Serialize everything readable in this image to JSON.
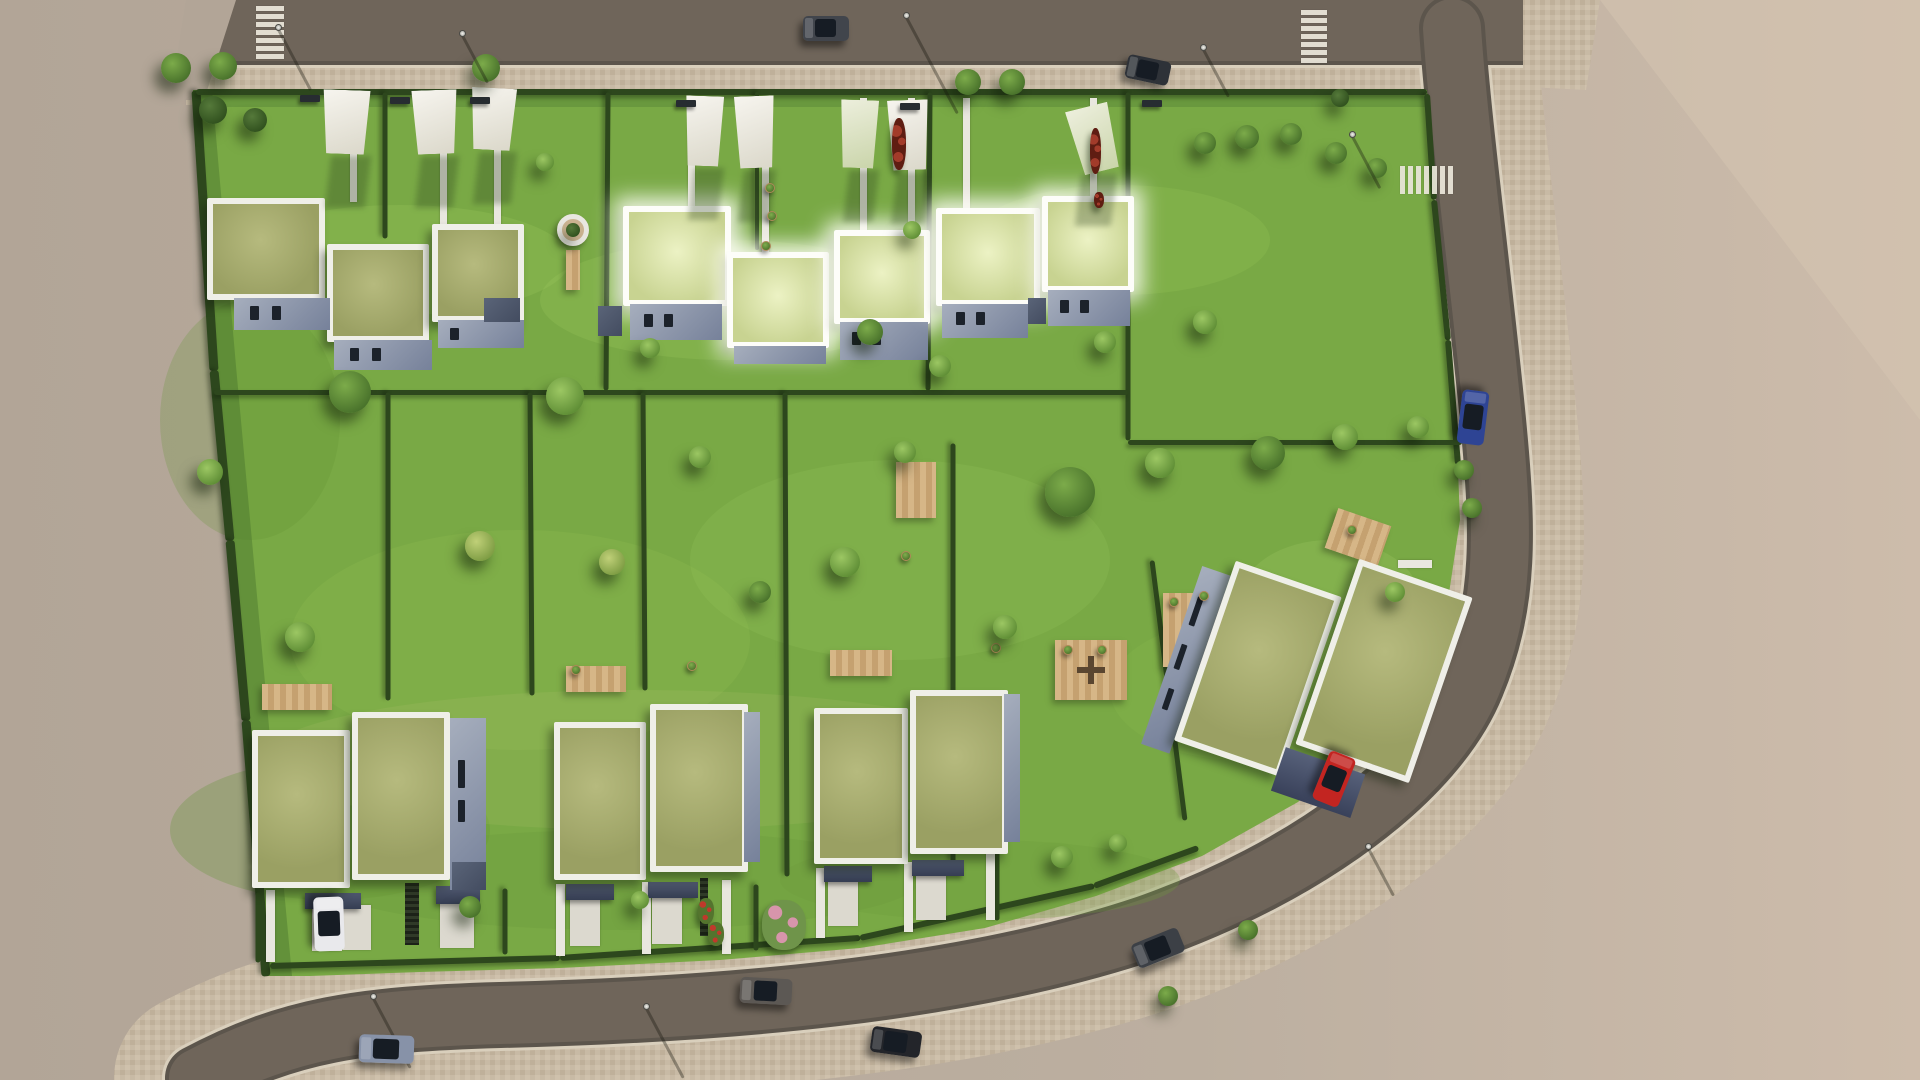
{
  "meta": {
    "title": "Aerial 3D site plan render - green-roof housing development",
    "width": 1920,
    "height": 1080,
    "description": "Top-down architectural visualization: three road edges, lawn parcels divided by hedges, two rows of white flat-roof houses with green (sedum) roofs, white shade sails, wooden decks, street trees and parked cars. No text appears in the image."
  },
  "palette": {
    "ground_left": "#b2a597",
    "ground_right": "#cdbcab",
    "ground_bright": "#d6c5b2",
    "asphalt": "#6f655a",
    "asphalt_edge": "#5c554c",
    "kerb": "#d9cfbc",
    "paver_a": "#c8baa5",
    "paver_b": "#bfb09a",
    "paver_c": "#cfc1ac",
    "lawn": "#79a945",
    "lawn_light": "#9cc75e",
    "lawn_dark": "#46702a",
    "hedge": "#2d471d",
    "roof_green": "#a9ad72",
    "roof_glow": "#d9e3a8",
    "parapet": "#efefe8",
    "wall_light": "#a6aebd",
    "wall_dark": "#4e586c",
    "deck_wood": "#cfae7f",
    "sail_white": "#f3f1ea",
    "path_concrete": "#e9e7df",
    "car_blue": "#2e4494",
    "car_red": "#c32521",
    "car_white": "#e9e9ec",
    "car_silver": "#8792a8"
  },
  "counts": {
    "house_clusters_top_row": 3,
    "house_clusters_bottom_row": 4,
    "shade_sails": 8,
    "vehicles": 9,
    "crosswalks": 3,
    "street_lamps": 8
  },
  "hedges": [
    [
      196,
      90,
      214,
      370,
      9
    ],
    [
      214,
      370,
      230,
      540,
      9
    ],
    [
      230,
      540,
      246,
      720,
      9
    ],
    [
      246,
      720,
      258,
      868,
      9
    ],
    [
      258,
      868,
      266,
      976,
      9
    ],
    [
      196,
      92,
      1427,
      92,
      6
    ],
    [
      1427,
      94,
      1434,
      200,
      6
    ],
    [
      1434,
      200,
      1448,
      340,
      6
    ],
    [
      1448,
      340,
      1458,
      465,
      6
    ],
    [
      270,
      966,
      560,
      958,
      6
    ],
    [
      560,
      958,
      860,
      938,
      6
    ],
    [
      860,
      938,
      1094,
      886,
      6
    ],
    [
      1094,
      886,
      1198,
      848,
      6
    ],
    [
      385,
      92,
      385,
      238,
      5
    ],
    [
      608,
      92,
      606,
      390,
      5
    ],
    [
      757,
      92,
      757,
      250,
      4
    ],
    [
      930,
      92,
      928,
      390,
      5
    ],
    [
      1128,
      92,
      1128,
      440,
      5
    ],
    [
      214,
      392,
      1128,
      392,
      5
    ],
    [
      1128,
      442,
      1462,
      442,
      5
    ],
    [
      388,
      392,
      388,
      700,
      5
    ],
    [
      530,
      392,
      532,
      695,
      5
    ],
    [
      643,
      392,
      645,
      690,
      5
    ],
    [
      785,
      392,
      787,
      876,
      5
    ],
    [
      953,
      443,
      953,
      862,
      5
    ],
    [
      1152,
      560,
      1185,
      820,
      5
    ],
    [
      258,
      892,
      258,
      962,
      5
    ],
    [
      505,
      888,
      505,
      954,
      5
    ],
    [
      756,
      884,
      756,
      950,
      5
    ],
    [
      997,
      850,
      997,
      920,
      5
    ]
  ],
  "crosswalks": [
    {
      "x": 256,
      "y": 6,
      "w": 28,
      "h": 54,
      "dir": "h",
      "stripes": 7
    },
    {
      "x": 1301,
      "y": 10,
      "w": 26,
      "h": 52,
      "dir": "h",
      "stripes": 7
    },
    {
      "x": 1400,
      "y": 166,
      "w": 52,
      "h": 28,
      "dir": "v",
      "stripes": 7
    }
  ],
  "paths": [
    [
      350,
      98,
      7,
      104
    ],
    [
      440,
      98,
      7,
      130
    ],
    [
      494,
      98,
      7,
      128
    ],
    [
      688,
      98,
      7,
      112
    ],
    [
      762,
      98,
      7,
      157
    ],
    [
      860,
      98,
      7,
      136
    ],
    [
      908,
      98,
      7,
      134
    ],
    [
      963,
      98,
      7,
      114
    ],
    [
      1090,
      98,
      7,
      102
    ],
    [
      1398,
      560,
      34,
      8
    ],
    [
      266,
      890,
      9,
      72
    ],
    [
      556,
      884,
      9,
      72
    ],
    [
      642,
      882,
      9,
      72
    ],
    [
      722,
      880,
      9,
      74
    ],
    [
      816,
      868,
      9,
      70
    ],
    [
      904,
      862,
      9,
      70
    ],
    [
      986,
      852,
      9,
      68
    ]
  ],
  "aprons": [
    [
      312,
      907,
      30,
      44
    ],
    [
      343,
      905,
      28,
      45
    ],
    [
      440,
      903,
      34,
      45
    ],
    [
      570,
      900,
      30,
      46
    ],
    [
      652,
      898,
      30,
      46
    ],
    [
      828,
      882,
      30,
      44
    ],
    [
      916,
      876,
      30,
      44
    ]
  ],
  "carports": [
    [
      305,
      893,
      56,
      16
    ],
    [
      436,
      886,
      44,
      18
    ],
    [
      566,
      884,
      48,
      16
    ],
    [
      648,
      882,
      50,
      16
    ],
    [
      824,
      866,
      48,
      16
    ],
    [
      912,
      860,
      52,
      16
    ]
  ],
  "slats": [
    [
      405,
      883,
      14,
      62
    ],
    [
      700,
      878,
      8,
      58
    ]
  ],
  "decks": [
    {
      "x": 262,
      "y": 684,
      "w": 70,
      "h": 26,
      "rot": 0
    },
    {
      "x": 566,
      "y": 666,
      "w": 60,
      "h": 26,
      "rot": 0
    },
    {
      "x": 830,
      "y": 650,
      "w": 62,
      "h": 26,
      "rot": 0
    },
    {
      "x": 1055,
      "y": 640,
      "w": 72,
      "h": 60,
      "rot": 0,
      "table": true
    },
    {
      "x": 1163,
      "y": 593,
      "w": 66,
      "h": 74,
      "rot": 0
    },
    {
      "x": 1330,
      "y": 516,
      "w": 56,
      "h": 42,
      "rot": 19
    },
    {
      "x": 566,
      "y": 250,
      "w": 14,
      "h": 40,
      "rot": 0
    },
    {
      "x": 896,
      "y": 462,
      "w": 40,
      "h": 56,
      "rot": 0
    }
  ],
  "clusters": [
    {
      "id": "top-1",
      "x": 0,
      "y": 0,
      "rot": 0,
      "blocks": [
        [
          "roof",
          207,
          198,
          118,
          102
        ],
        [
          "roof",
          327,
          244,
          102,
          98
        ],
        [
          "roof",
          432,
          224,
          92,
          98
        ],
        [
          "wall",
          234,
          298,
          96,
          32
        ],
        [
          "win",
          250,
          306,
          9,
          14
        ],
        [
          "win",
          272,
          306,
          9,
          14
        ],
        [
          "wall",
          334,
          340,
          98,
          30
        ],
        [
          "win",
          350,
          348,
          9,
          13
        ],
        [
          "win",
          372,
          348,
          9,
          13
        ],
        [
          "wall",
          438,
          320,
          86,
          28
        ],
        [
          "win",
          450,
          328,
          9,
          12
        ],
        [
          "wallD",
          484,
          298,
          36,
          24
        ]
      ]
    },
    {
      "id": "top-2",
      "x": 0,
      "y": 0,
      "rot": 0,
      "blocks": [
        [
          "roofG",
          623,
          206,
          108,
          100
        ],
        [
          "roofG",
          727,
          252,
          102,
          96
        ],
        [
          "roofG",
          834,
          230,
          96,
          94
        ],
        [
          "wallD",
          598,
          306,
          24,
          30
        ],
        [
          "wall",
          630,
          304,
          92,
          36
        ],
        [
          "win",
          644,
          314,
          9,
          13
        ],
        [
          "win",
          664,
          314,
          9,
          13
        ],
        [
          "wall",
          734,
          346,
          92,
          18
        ],
        [
          "wall",
          840,
          322,
          88,
          38
        ],
        [
          "win",
          852,
          332,
          9,
          13
        ],
        [
          "win",
          872,
          332,
          9,
          13
        ]
      ]
    },
    {
      "id": "top-3",
      "x": 0,
      "y": 0,
      "rot": 0,
      "blocks": [
        [
          "roofG",
          936,
          208,
          104,
          98
        ],
        [
          "roofG",
          1042,
          196,
          92,
          96
        ],
        [
          "wall",
          942,
          304,
          86,
          34
        ],
        [
          "win",
          956,
          312,
          9,
          13
        ],
        [
          "win",
          976,
          312,
          9,
          13
        ],
        [
          "wallD",
          1028,
          298,
          18,
          26
        ],
        [
          "wall",
          1048,
          290,
          82,
          36
        ],
        [
          "win",
          1060,
          300,
          9,
          13
        ],
        [
          "win",
          1080,
          300,
          9,
          13
        ]
      ]
    },
    {
      "id": "bottom-1",
      "x": 0,
      "y": 0,
      "rot": 0,
      "blocks": [
        [
          "roof",
          252,
          730,
          98,
          158
        ],
        [
          "roof",
          352,
          712,
          98,
          168
        ],
        [
          "wall",
          450,
          718,
          36,
          172
        ],
        [
          "win",
          458,
          760,
          7,
          28
        ],
        [
          "win",
          458,
          800,
          7,
          22
        ],
        [
          "wallD",
          452,
          862,
          34,
          28
        ]
      ]
    },
    {
      "id": "bottom-2",
      "x": 0,
      "y": 0,
      "rot": 0,
      "blocks": [
        [
          "roof",
          554,
          722,
          92,
          158
        ],
        [
          "roof",
          650,
          704,
          98,
          168
        ],
        [
          "wall",
          744,
          712,
          16,
          150
        ]
      ]
    },
    {
      "id": "bottom-3",
      "x": 0,
      "y": 0,
      "rot": 0,
      "blocks": [
        [
          "roof",
          814,
          708,
          94,
          156
        ],
        [
          "roof",
          910,
          690,
          98,
          164
        ],
        [
          "wall",
          1004,
          694,
          16,
          148
        ]
      ]
    },
    {
      "id": "bottom-4",
      "x": 1165,
      "y": 520,
      "w": 300,
      "h": 285,
      "rot": 19,
      "blocks": [
        [
          "wall",
          12,
          88,
          30,
          188
        ],
        [
          "win",
          18,
          118,
          6,
          30
        ],
        [
          "win",
          18,
          168,
          6,
          26
        ],
        [
          "win",
          20,
          214,
          6,
          22
        ],
        [
          "roof",
          42,
          72,
          112,
          190
        ],
        [
          "roof",
          158,
          30,
          120,
          196
        ],
        [
          "drive",
          150,
          232,
          84,
          46
        ]
      ]
    }
  ],
  "sails": [
    {
      "x": 320,
      "y": 90,
      "w": 52,
      "h": 64,
      "rot": 2,
      "plant": false
    },
    {
      "x": 410,
      "y": 90,
      "w": 50,
      "h": 64,
      "rot": -2,
      "plant": false
    },
    {
      "x": 468,
      "y": 88,
      "w": 50,
      "h": 62,
      "rot": 3,
      "plant": false
    },
    {
      "x": 683,
      "y": 96,
      "w": 42,
      "h": 70,
      "rot": 2,
      "plant": false
    },
    {
      "x": 733,
      "y": 96,
      "w": 44,
      "h": 72,
      "rot": -2,
      "plant": false
    },
    {
      "x": 838,
      "y": 100,
      "w": 42,
      "h": 68,
      "rot": 2,
      "plant": true
    },
    {
      "x": 886,
      "y": 100,
      "w": 45,
      "h": 70,
      "rot": -2,
      "plant": false
    },
    {
      "x": 1070,
      "y": 106,
      "w": 48,
      "h": 66,
      "rot": -14,
      "plant": true
    }
  ],
  "trees": [
    [
      176,
      68,
      15,
      "mid"
    ],
    [
      223,
      66,
      14,
      "mid"
    ],
    [
      486,
      68,
      14,
      "mid"
    ],
    [
      213,
      110,
      14,
      "dark"
    ],
    [
      255,
      120,
      12,
      "dark"
    ],
    [
      968,
      82,
      13,
      "mid"
    ],
    [
      1012,
      82,
      13,
      "mid"
    ],
    [
      1205,
      143,
      11,
      "mid"
    ],
    [
      1247,
      137,
      12,
      "mid"
    ],
    [
      1291,
      134,
      11,
      "mid"
    ],
    [
      1336,
      153,
      11,
      "mid"
    ],
    [
      1377,
      168,
      10,
      "mid"
    ],
    [
      545,
      162,
      9,
      "light"
    ],
    [
      1340,
      98,
      9,
      "dark"
    ],
    [
      350,
      392,
      21,
      "mid"
    ],
    [
      565,
      396,
      19,
      "light"
    ],
    [
      650,
      348,
      10,
      "light"
    ],
    [
      870,
      332,
      13,
      "mid"
    ],
    [
      940,
      366,
      11,
      "light"
    ],
    [
      1105,
      342,
      11,
      "light"
    ],
    [
      1205,
      322,
      12,
      "light"
    ],
    [
      210,
      472,
      13,
      "light"
    ],
    [
      300,
      637,
      15,
      "light"
    ],
    [
      480,
      546,
      15,
      "yellow"
    ],
    [
      612,
      562,
      13,
      "yellow"
    ],
    [
      700,
      457,
      11,
      "light"
    ],
    [
      760,
      592,
      11,
      "mid"
    ],
    [
      845,
      562,
      15,
      "light"
    ],
    [
      905,
      452,
      11,
      "light"
    ],
    [
      1005,
      627,
      12,
      "light"
    ],
    [
      1070,
      492,
      25,
      "mid"
    ],
    [
      1160,
      463,
      15,
      "light"
    ],
    [
      1268,
      453,
      17,
      "mid"
    ],
    [
      1345,
      437,
      13,
      "light"
    ],
    [
      1418,
      427,
      11,
      "light"
    ],
    [
      470,
      907,
      11,
      "mid"
    ],
    [
      640,
      900,
      9,
      "light"
    ],
    [
      1062,
      857,
      11,
      "light"
    ],
    [
      1118,
      843,
      9,
      "light"
    ],
    [
      912,
      230,
      9,
      "light"
    ],
    [
      1395,
      592,
      10,
      "light"
    ]
  ],
  "flower_beds": [
    {
      "x": 892,
      "y": 118,
      "w": 14,
      "h": 52,
      "kind": "darkred"
    },
    {
      "x": 1090,
      "y": 128,
      "w": 11,
      "h": 46,
      "kind": "darkred"
    },
    {
      "x": 1094,
      "y": 192,
      "w": 10,
      "h": 16,
      "kind": "darkred"
    },
    {
      "x": 698,
      "y": 898,
      "w": 16,
      "h": 26,
      "kind": "red"
    },
    {
      "x": 708,
      "y": 922,
      "w": 16,
      "h": 24,
      "kind": "red"
    },
    {
      "x": 762,
      "y": 900,
      "w": 44,
      "h": 50,
      "kind": "pink"
    }
  ],
  "pots_small": [
    [
      770,
      188
    ],
    [
      772,
      216
    ],
    [
      766,
      246
    ],
    [
      1068,
      650
    ],
    [
      1102,
      650
    ],
    [
      1174,
      602
    ],
    [
      1204,
      596
    ],
    [
      1352,
      530
    ],
    [
      576,
      670
    ],
    [
      692,
      666
    ],
    [
      996,
      648
    ],
    [
      906,
      556
    ]
  ],
  "pots_street": [
    [
      1464,
      470
    ],
    [
      1472,
      508
    ],
    [
      1248,
      930
    ],
    [
      1168,
      996
    ]
  ],
  "ring_planter": {
    "x": 573,
    "y": 230,
    "r": 16
  },
  "benches": [
    [
      300,
      95
    ],
    [
      390,
      97
    ],
    [
      470,
      97
    ],
    [
      676,
      100
    ],
    [
      900,
      103
    ],
    [
      1142,
      100
    ]
  ],
  "lamps": [
    {
      "x": 278,
      "y": 27,
      "len": 70
    },
    {
      "x": 462,
      "y": 33,
      "len": 55
    },
    {
      "x": 906,
      "y": 15,
      "len": 110
    },
    {
      "x": 1203,
      "y": 47,
      "len": 55
    },
    {
      "x": 1352,
      "y": 134,
      "len": 60
    },
    {
      "x": 373,
      "y": 996,
      "len": 80
    },
    {
      "x": 646,
      "y": 1006,
      "len": 80
    },
    {
      "x": 1368,
      "y": 846,
      "len": 55
    }
  ],
  "vehicles": [
    {
      "id": "car-top-1",
      "cx": 826,
      "cy": 28,
      "len": 46,
      "wid": 25,
      "rot": 0,
      "color": "#41454c"
    },
    {
      "id": "car-top-2",
      "cx": 1148,
      "cy": 70,
      "len": 44,
      "wid": 24,
      "rot": 12,
      "color": "#2e3238"
    },
    {
      "id": "car-blue-right",
      "cx": 1473,
      "cy": 417,
      "len": 54,
      "wid": 27,
      "rot": 97,
      "color": "#2e4494"
    },
    {
      "id": "car-white-driveway",
      "cx": 329,
      "cy": 924,
      "len": 54,
      "wid": 30,
      "rot": 88,
      "color": "#e9e9ec"
    },
    {
      "id": "car-red-driveway",
      "cx": 1334,
      "cy": 779,
      "len": 52,
      "wid": 28,
      "rot": 112,
      "color": "#c32521"
    },
    {
      "id": "car-silver-bottom",
      "cx": 386,
      "cy": 1049,
      "len": 55,
      "wid": 28,
      "rot": 2,
      "color": "#8792a8"
    },
    {
      "id": "car-gray-bottom",
      "cx": 766,
      "cy": 991,
      "len": 52,
      "wid": 26,
      "rot": 3,
      "color": "#5c5854"
    },
    {
      "id": "car-black-bottom",
      "cx": 896,
      "cy": 1042,
      "len": 50,
      "wid": 26,
      "rot": 8,
      "color": "#23252a"
    },
    {
      "id": "car-dark-curve",
      "cx": 1158,
      "cy": 948,
      "len": 50,
      "wid": 26,
      "rot": -22,
      "color": "#3c4046"
    }
  ]
}
